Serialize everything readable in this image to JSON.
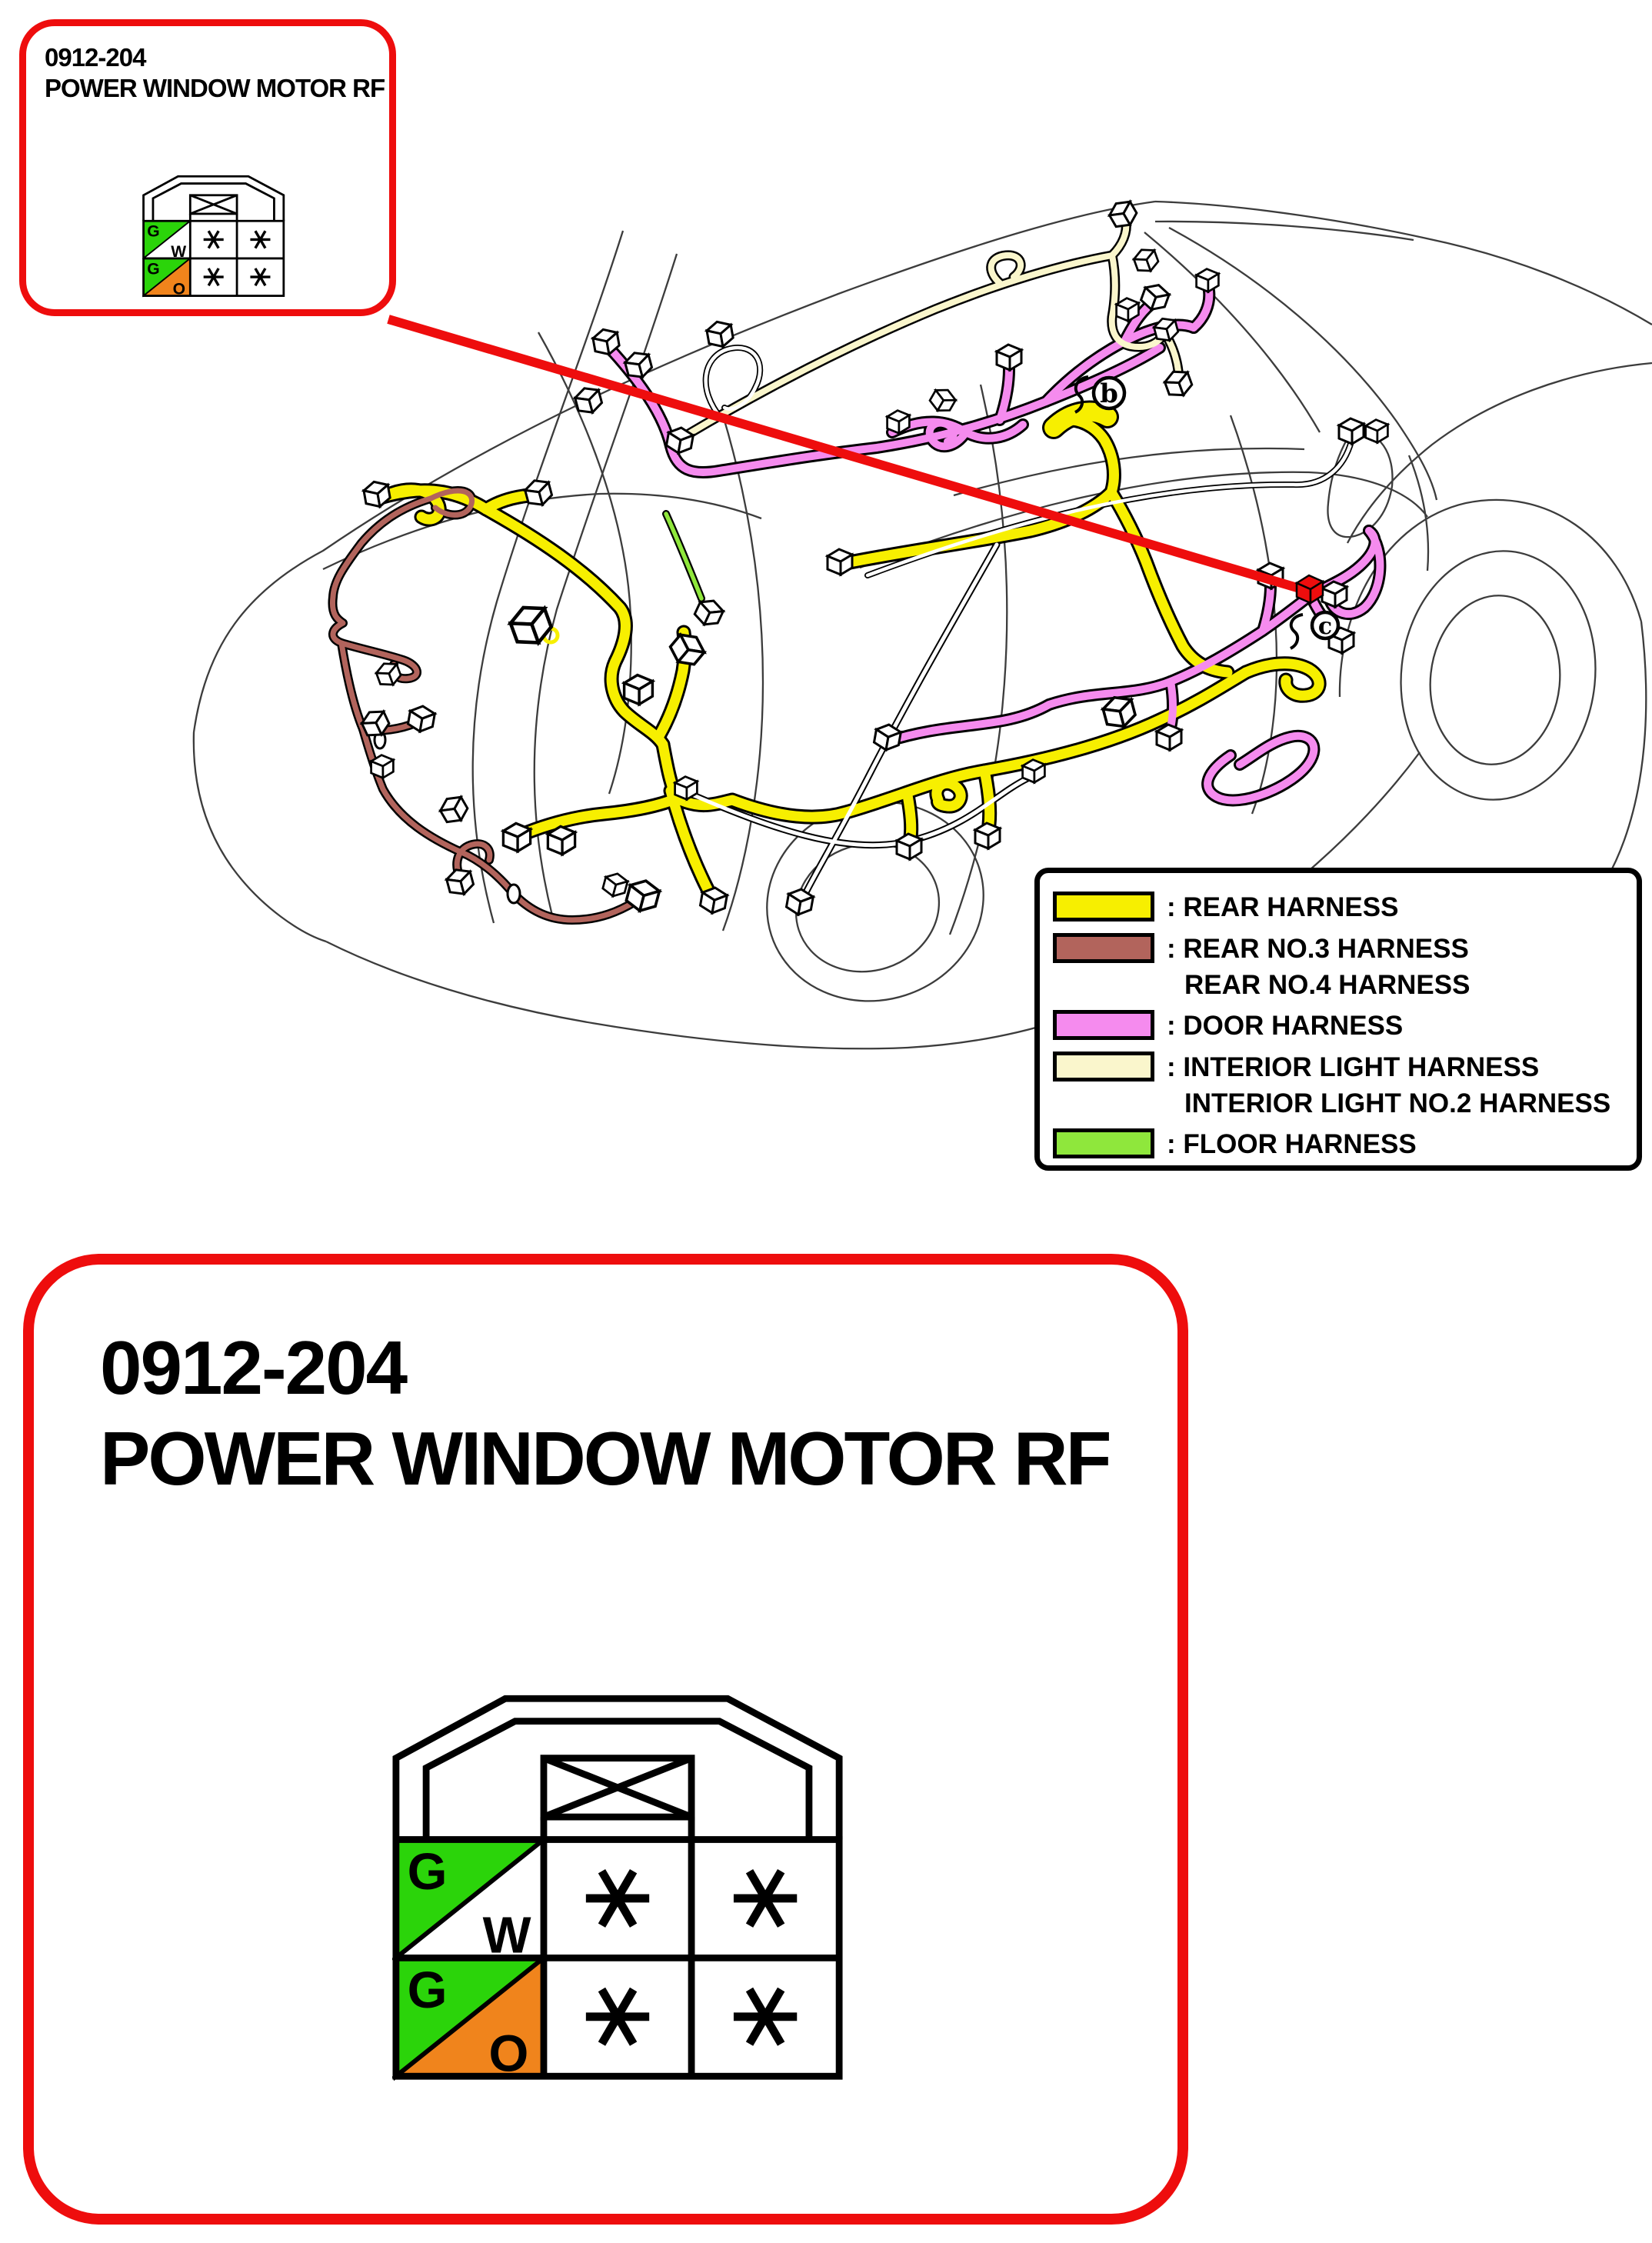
{
  "page": {
    "background": "#FFFFFF"
  },
  "colors": {
    "accent_red": "#EE0D0D",
    "wire_white": "#FFFFFF",
    "outline_gray": "#3C3C3C"
  },
  "callout_small": {
    "code": "0912-204",
    "title": "POWER WINDOW MOTOR RF"
  },
  "callout_large": {
    "code": "0912-204",
    "title": "POWER WINDOW MOTOR RF"
  },
  "connector": {
    "rows": [
      {
        "top_label": "G",
        "top_color": "#2BD40A",
        "bottom_label": "W",
        "bottom_color": "#FFFFFF",
        "cells": [
          "*",
          "*"
        ]
      },
      {
        "top_label": "G",
        "top_color": "#2BD40A",
        "bottom_label": "O",
        "bottom_color": "#F0841C",
        "cells": [
          "*",
          "*"
        ]
      }
    ]
  },
  "legend": {
    "items": [
      {
        "name": "rear-harness",
        "color": "#F7EF00",
        "lines": [
          ": REAR HARNESS"
        ]
      },
      {
        "name": "rear-no3-no4-harness",
        "color": "#B2645C",
        "lines": [
          ": REAR NO.3 HARNESS",
          "REAR NO.4 HARNESS"
        ]
      },
      {
        "name": "door-harness",
        "color": "#F58BEE",
        "lines": [
          ": DOOR HARNESS"
        ]
      },
      {
        "name": "interior-light-harness",
        "color": "#FAF6CC",
        "lines": [
          ": INTERIOR LIGHT HARNESS",
          "INTERIOR LIGHT NO.2 HARNESS"
        ]
      },
      {
        "name": "floor-harness",
        "color": "#8FE73C",
        "lines": [
          ": FLOOR HARNESS"
        ]
      }
    ]
  },
  "markers": {
    "b": "b",
    "c": "c"
  }
}
